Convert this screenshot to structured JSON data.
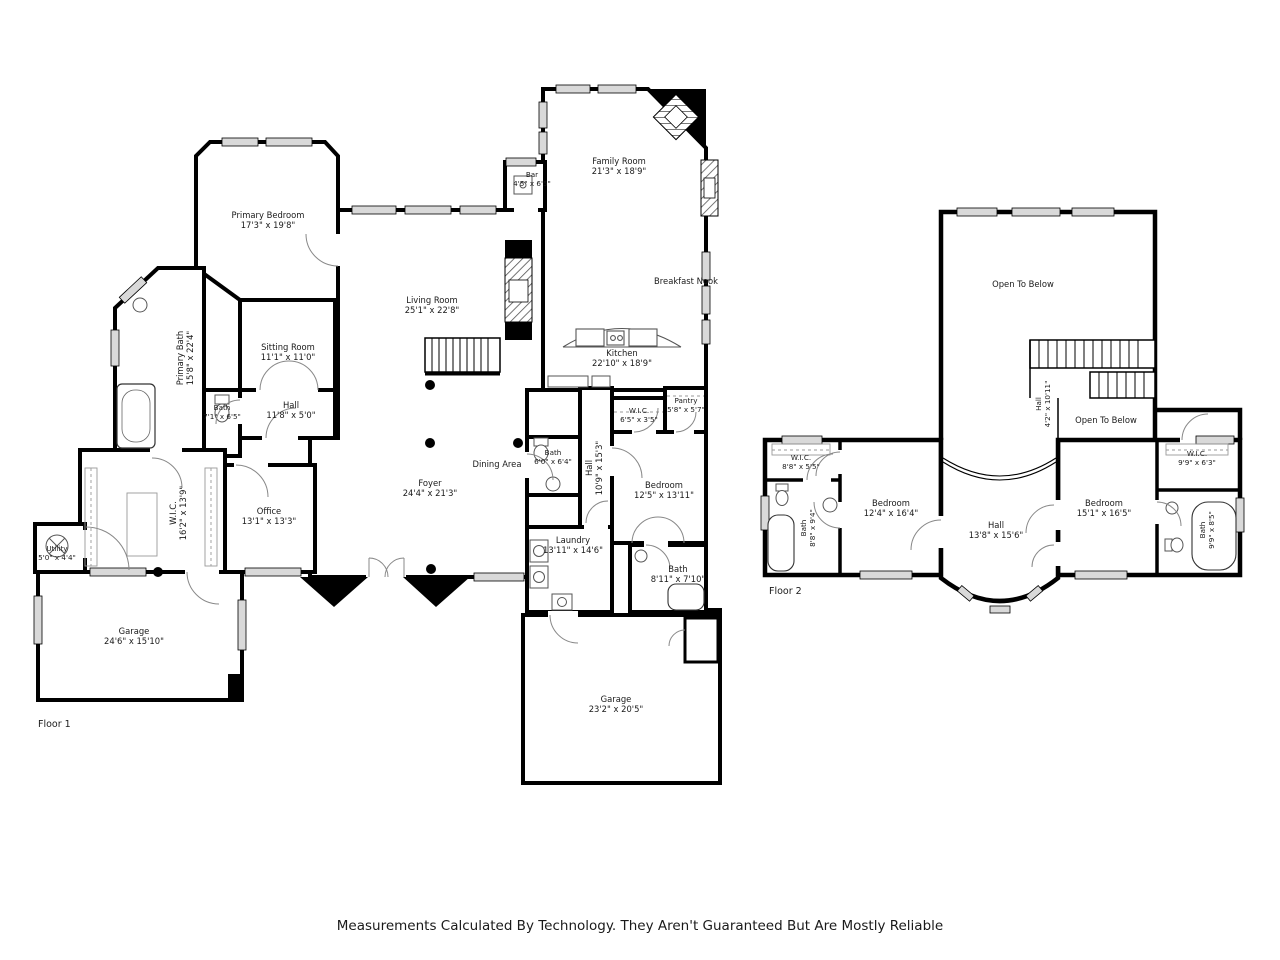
{
  "meta": {
    "floor1_label": "Floor 1",
    "floor2_label": "Floor 2",
    "disclaimer": "Measurements Calculated By Technology. They Aren't Guaranteed But Are Mostly Reliable"
  },
  "colors": {
    "wall": "#000000",
    "window": "#d9d9d9",
    "door_arc": "#888888",
    "text": "#1a1a1a",
    "background": "#ffffff"
  },
  "floor1": {
    "label": "Floor 1",
    "rooms": [
      {
        "name": "Primary Bedroom",
        "dims": "17'3\" x 19'8\""
      },
      {
        "name": "Bar",
        "dims": "4'5\" x 6'5\""
      },
      {
        "name": "Family Room",
        "dims": "21'3\" x 18'9\""
      },
      {
        "name": "Living Room",
        "dims": "25'1\" x 22'8\""
      },
      {
        "name": "Breakfast Nook",
        "dims": ""
      },
      {
        "name": "Kitchen",
        "dims": "22'10\" x 18'9\""
      },
      {
        "name": "Primary Bath",
        "dims": "15'8\" x 22'4\""
      },
      {
        "name": "Sitting Room",
        "dims": "11'1\" x 11'0\""
      },
      {
        "name": "Bath",
        "dims": "7'1\" x 6'5\""
      },
      {
        "name": "Hall",
        "dims": "11'8\" x 5'0\""
      },
      {
        "name": "Pantry",
        "dims": "5'8\" x 5'7\""
      },
      {
        "name": "W.I.C.",
        "dims": "6'5\" x 3'5\""
      },
      {
        "name": "W.I.C.",
        "dims": "16'2\" x 13'9\""
      },
      {
        "name": "Office",
        "dims": "13'1\" x 13'3\""
      },
      {
        "name": "Foyer",
        "dims": "24'4\" x 21'3\""
      },
      {
        "name": "Dining Area",
        "dims": ""
      },
      {
        "name": "Bath",
        "dims": "6'0\" x 6'4\""
      },
      {
        "name": "Hall",
        "dims": "10'9\" x 15'3\""
      },
      {
        "name": "Bedroom",
        "dims": "12'5\" x 13'11\""
      },
      {
        "name": "Laundry",
        "dims": "13'11\" x 14'6\""
      },
      {
        "name": "Bath",
        "dims": "8'11\" x 7'10\""
      },
      {
        "name": "Utility",
        "dims": "5'0\" x 4'4\""
      },
      {
        "name": "Garage",
        "dims": "24'6\" x 15'10\""
      },
      {
        "name": "Garage",
        "dims": "23'2\" x 20'5\""
      }
    ]
  },
  "floor2": {
    "label": "Floor 2",
    "rooms": [
      {
        "name": "Open To Below",
        "dims": ""
      },
      {
        "name": "Hall",
        "dims": "4'2\" x 10'11\""
      },
      {
        "name": "Open To Below",
        "dims": ""
      },
      {
        "name": "W.I.C.",
        "dims": "8'8\" x 5'5\""
      },
      {
        "name": "Bedroom",
        "dims": "12'4\" x 16'4\""
      },
      {
        "name": "Hall",
        "dims": "13'8\" x 15'6\""
      },
      {
        "name": "Bedroom",
        "dims": "15'1\" x 16'5\""
      },
      {
        "name": "W.I.C.",
        "dims": "9'9\" x 6'3\""
      },
      {
        "name": "Bath",
        "dims": "8'8\" x 9'4\""
      },
      {
        "name": "Bath",
        "dims": "9'9\" x 8'5\""
      }
    ]
  }
}
